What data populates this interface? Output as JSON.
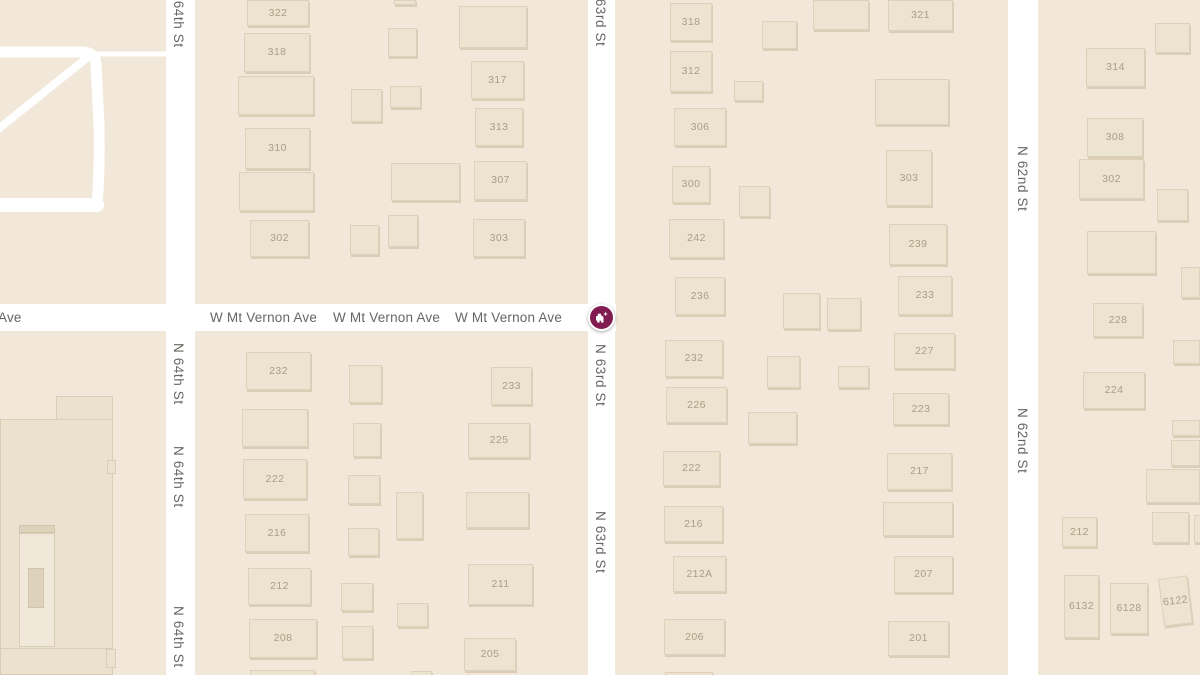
{
  "map": {
    "background_color": "#F1E8D9",
    "road_color": "#FFFFFF",
    "building_color": "#ECE3D1",
    "building_number_color": "#AC9D83",
    "road_label_color": "#666663",
    "marker_color": "#811C50"
  },
  "streets": {
    "vertical": [
      {
        "id": "n-64th-st",
        "name": "N 64th St",
        "x": 166,
        "width": 29,
        "label_x": 171,
        "labels_y": [
          -14,
          343,
          446,
          606
        ]
      },
      {
        "id": "n-63rd-st",
        "name": "N 63rd St",
        "x": 588,
        "width": 27,
        "label_x": 593,
        "labels_y": [
          -16,
          344,
          511
        ]
      },
      {
        "id": "n-62nd-st",
        "name": "N 62nd St",
        "x": 1008,
        "width": 30,
        "label_x": 1015,
        "labels_y": [
          146,
          408
        ]
      }
    ],
    "horizontal": [
      {
        "id": "w-mt-vernon-ave",
        "name": "W Mt Vernon Ave",
        "x": -4,
        "y": 304,
        "width": 620,
        "height": 27,
        "label_y": 310,
        "labels_x": [
          210,
          333,
          455
        ],
        "fragment": {
          "text": "Ave",
          "x": -2,
          "y": 310
        }
      }
    ]
  },
  "driveways": [
    {
      "d": "M-8,52 L82,52 Q95,52 96,64 L99,125 Q100,168 97,205",
      "w": 11
    },
    {
      "d": "M-8,205 L97,205",
      "w": 14
    },
    {
      "d": "M-8,134 L88,57",
      "w": 8
    },
    {
      "d": "M90,54 L172,54",
      "w": 5
    }
  ],
  "marker": {
    "kind": "crash-incident",
    "x": 601,
    "y": 317,
    "color": "#811C50"
  },
  "buildings": [
    {
      "n": "",
      "x": 56,
      "y": 396,
      "w": 57,
      "h": 52,
      "v": "site"
    },
    {
      "n": "",
      "x": 0,
      "y": 419,
      "w": 113,
      "h": 256,
      "v": "site"
    },
    {
      "n": "",
      "x": 107,
      "y": 460,
      "w": 9,
      "h": 14,
      "v": "site"
    },
    {
      "n": "",
      "x": 0,
      "y": 648,
      "w": 113,
      "h": 27,
      "v": "site"
    },
    {
      "n": "",
      "x": 106,
      "y": 649,
      "w": 10,
      "h": 19,
      "v": "site"
    },
    {
      "n": "",
      "x": 19,
      "y": 525,
      "w": 36,
      "h": 8,
      "v": "site-dark"
    },
    {
      "n": "",
      "x": 19,
      "y": 533,
      "w": 36,
      "h": 114,
      "v": "site-light"
    },
    {
      "n": "",
      "x": 28,
      "y": 568,
      "w": 16,
      "h": 40,
      "v": "site-dark"
    },
    {
      "n": "322",
      "x": 247,
      "y": 0,
      "w": 62,
      "h": 26
    },
    {
      "n": "318",
      "x": 244,
      "y": 33,
      "w": 66,
      "h": 39
    },
    {
      "n": "",
      "x": 238,
      "y": 76,
      "w": 76,
      "h": 39
    },
    {
      "n": "310",
      "x": 245,
      "y": 128,
      "w": 65,
      "h": 41
    },
    {
      "n": "",
      "x": 239,
      "y": 172,
      "w": 75,
      "h": 39
    },
    {
      "n": "302",
      "x": 250,
      "y": 220,
      "w": 59,
      "h": 37
    },
    {
      "n": "",
      "x": 394,
      "y": 0,
      "w": 22,
      "h": 5
    },
    {
      "n": "",
      "x": 388,
      "y": 28,
      "w": 29,
      "h": 29
    },
    {
      "n": "",
      "x": 351,
      "y": 89,
      "w": 31,
      "h": 33
    },
    {
      "n": "",
      "x": 390,
      "y": 86,
      "w": 31,
      "h": 22
    },
    {
      "n": "",
      "x": 391,
      "y": 163,
      "w": 69,
      "h": 38
    },
    {
      "n": "",
      "x": 388,
      "y": 215,
      "w": 30,
      "h": 32
    },
    {
      "n": "",
      "x": 350,
      "y": 225,
      "w": 29,
      "h": 30
    },
    {
      "n": "",
      "x": 459,
      "y": 6,
      "w": 68,
      "h": 42
    },
    {
      "n": "317",
      "x": 471,
      "y": 61,
      "w": 53,
      "h": 38
    },
    {
      "n": "313",
      "x": 475,
      "y": 108,
      "w": 48,
      "h": 38
    },
    {
      "n": "307",
      "x": 474,
      "y": 161,
      "w": 53,
      "h": 39
    },
    {
      "n": "303",
      "x": 473,
      "y": 219,
      "w": 52,
      "h": 38
    },
    {
      "n": "232",
      "x": 246,
      "y": 352,
      "w": 65,
      "h": 38
    },
    {
      "n": "",
      "x": 242,
      "y": 409,
      "w": 66,
      "h": 38
    },
    {
      "n": "222",
      "x": 243,
      "y": 459,
      "w": 64,
      "h": 40
    },
    {
      "n": "216",
      "x": 245,
      "y": 514,
      "w": 64,
      "h": 38
    },
    {
      "n": "212",
      "x": 248,
      "y": 568,
      "w": 63,
      "h": 37
    },
    {
      "n": "208",
      "x": 249,
      "y": 619,
      "w": 68,
      "h": 39
    },
    {
      "n": "",
      "x": 250,
      "y": 670,
      "w": 65,
      "h": 12
    },
    {
      "n": "",
      "x": 349,
      "y": 365,
      "w": 33,
      "h": 38
    },
    {
      "n": "",
      "x": 353,
      "y": 423,
      "w": 28,
      "h": 34
    },
    {
      "n": "",
      "x": 348,
      "y": 475,
      "w": 32,
      "h": 29
    },
    {
      "n": "",
      "x": 396,
      "y": 492,
      "w": 27,
      "h": 47
    },
    {
      "n": "",
      "x": 348,
      "y": 528,
      "w": 31,
      "h": 28
    },
    {
      "n": "",
      "x": 341,
      "y": 583,
      "w": 32,
      "h": 28
    },
    {
      "n": "",
      "x": 397,
      "y": 603,
      "w": 31,
      "h": 24
    },
    {
      "n": "",
      "x": 342,
      "y": 626,
      "w": 31,
      "h": 33
    },
    {
      "n": "",
      "x": 411,
      "y": 671,
      "w": 21,
      "h": 10
    },
    {
      "n": "233",
      "x": 491,
      "y": 367,
      "w": 41,
      "h": 38
    },
    {
      "n": "225",
      "x": 468,
      "y": 423,
      "w": 62,
      "h": 35
    },
    {
      "n": "",
      "x": 466,
      "y": 492,
      "w": 63,
      "h": 36
    },
    {
      "n": "211",
      "x": 468,
      "y": 564,
      "w": 65,
      "h": 41
    },
    {
      "n": "205",
      "x": 464,
      "y": 638,
      "w": 52,
      "h": 33
    },
    {
      "n": "318",
      "x": 670,
      "y": 3,
      "w": 42,
      "h": 38
    },
    {
      "n": "312",
      "x": 670,
      "y": 51,
      "w": 42,
      "h": 41
    },
    {
      "n": "306",
      "x": 674,
      "y": 108,
      "w": 52,
      "h": 38
    },
    {
      "n": "300",
      "x": 672,
      "y": 166,
      "w": 38,
      "h": 37
    },
    {
      "n": "242",
      "x": 669,
      "y": 219,
      "w": 55,
      "h": 39
    },
    {
      "n": "236",
      "x": 675,
      "y": 277,
      "w": 50,
      "h": 38
    },
    {
      "n": "",
      "x": 762,
      "y": 21,
      "w": 35,
      "h": 28
    },
    {
      "n": "",
      "x": 734,
      "y": 81,
      "w": 29,
      "h": 20
    },
    {
      "n": "",
      "x": 739,
      "y": 186,
      "w": 31,
      "h": 31
    },
    {
      "n": "",
      "x": 813,
      "y": 0,
      "w": 56,
      "h": 30
    },
    {
      "n": "321",
      "x": 888,
      "y": 0,
      "w": 65,
      "h": 31
    },
    {
      "n": "",
      "x": 875,
      "y": 79,
      "w": 74,
      "h": 46
    },
    {
      "n": "303",
      "x": 886,
      "y": 150,
      "w": 46,
      "h": 56
    },
    {
      "n": "239",
      "x": 889,
      "y": 224,
      "w": 58,
      "h": 41
    },
    {
      "n": "233",
      "x": 898,
      "y": 276,
      "w": 54,
      "h": 39
    },
    {
      "n": "232",
      "x": 665,
      "y": 340,
      "w": 58,
      "h": 37
    },
    {
      "n": "226",
      "x": 666,
      "y": 387,
      "w": 61,
      "h": 36
    },
    {
      "n": "222",
      "x": 663,
      "y": 451,
      "w": 57,
      "h": 35
    },
    {
      "n": "216",
      "x": 664,
      "y": 506,
      "w": 59,
      "h": 36
    },
    {
      "n": "212A",
      "x": 673,
      "y": 556,
      "w": 53,
      "h": 36
    },
    {
      "n": "206",
      "x": 664,
      "y": 619,
      "w": 61,
      "h": 36
    },
    {
      "n": "",
      "x": 665,
      "y": 672,
      "w": 48,
      "h": 10
    },
    {
      "n": "",
      "x": 783,
      "y": 293,
      "w": 37,
      "h": 36
    },
    {
      "n": "",
      "x": 827,
      "y": 298,
      "w": 34,
      "h": 32
    },
    {
      "n": "",
      "x": 767,
      "y": 356,
      "w": 33,
      "h": 32
    },
    {
      "n": "",
      "x": 838,
      "y": 366,
      "w": 31,
      "h": 22
    },
    {
      "n": "",
      "x": 748,
      "y": 412,
      "w": 49,
      "h": 32
    },
    {
      "n": "227",
      "x": 894,
      "y": 333,
      "w": 61,
      "h": 36
    },
    {
      "n": "223",
      "x": 893,
      "y": 393,
      "w": 56,
      "h": 32
    },
    {
      "n": "217",
      "x": 887,
      "y": 453,
      "w": 65,
      "h": 37
    },
    {
      "n": "",
      "x": 883,
      "y": 502,
      "w": 70,
      "h": 34
    },
    {
      "n": "207",
      "x": 894,
      "y": 556,
      "w": 59,
      "h": 37
    },
    {
      "n": "201",
      "x": 888,
      "y": 621,
      "w": 61,
      "h": 35
    },
    {
      "n": "",
      "x": 1155,
      "y": 23,
      "w": 35,
      "h": 30
    },
    {
      "n": "314",
      "x": 1086,
      "y": 48,
      "w": 59,
      "h": 39
    },
    {
      "n": "308",
      "x": 1087,
      "y": 118,
      "w": 56,
      "h": 39
    },
    {
      "n": "302",
      "x": 1079,
      "y": 159,
      "w": 65,
      "h": 40
    },
    {
      "n": "",
      "x": 1157,
      "y": 189,
      "w": 31,
      "h": 32
    },
    {
      "n": "",
      "x": 1087,
      "y": 231,
      "w": 69,
      "h": 43
    },
    {
      "n": "",
      "x": 1181,
      "y": 267,
      "w": 19,
      "h": 31
    },
    {
      "n": "228",
      "x": 1093,
      "y": 303,
      "w": 50,
      "h": 34
    },
    {
      "n": "",
      "x": 1173,
      "y": 340,
      "w": 27,
      "h": 24
    },
    {
      "n": "224",
      "x": 1083,
      "y": 372,
      "w": 62,
      "h": 37
    },
    {
      "n": "",
      "x": 1172,
      "y": 420,
      "w": 28,
      "h": 16
    },
    {
      "n": "",
      "x": 1171,
      "y": 440,
      "w": 29,
      "h": 26
    },
    {
      "n": "",
      "x": 1146,
      "y": 469,
      "w": 54,
      "h": 34
    },
    {
      "n": "",
      "x": 1152,
      "y": 512,
      "w": 37,
      "h": 31
    },
    {
      "n": "",
      "x": 1194,
      "y": 515,
      "w": 8,
      "h": 28
    },
    {
      "n": "212",
      "x": 1062,
      "y": 517,
      "w": 35,
      "h": 30
    },
    {
      "n": "6132",
      "x": 1064,
      "y": 575,
      "w": 35,
      "h": 63
    },
    {
      "n": "6128",
      "x": 1110,
      "y": 583,
      "w": 38,
      "h": 51
    },
    {
      "n": "6122",
      "x": 1161,
      "y": 577,
      "w": 29,
      "h": 48,
      "r": -7
    }
  ]
}
